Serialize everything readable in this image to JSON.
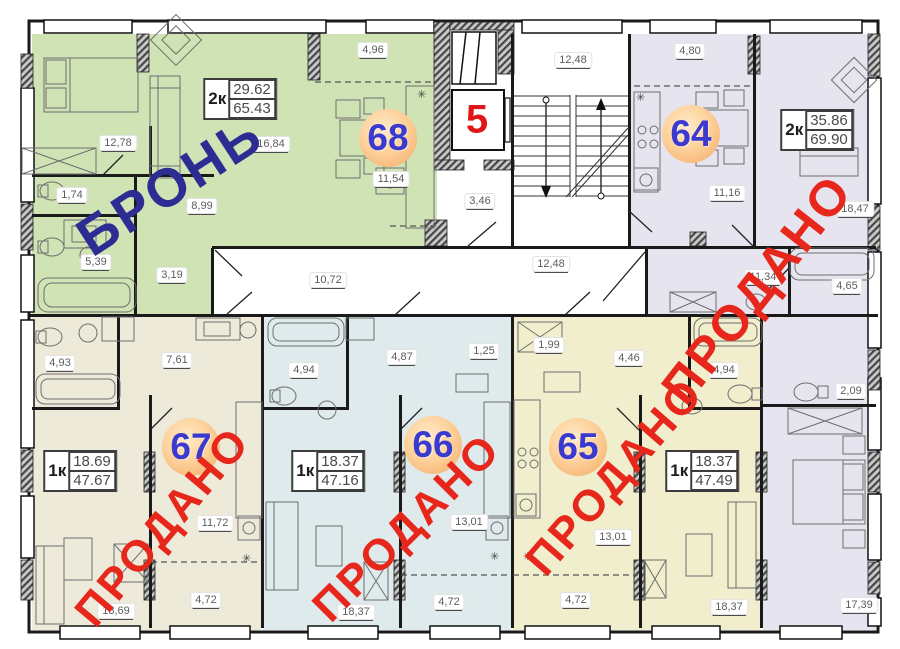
{
  "floor_plan": {
    "elevator_floor_label": "5",
    "common_areas": {
      "measurements": [
        {
          "v": "12,48",
          "x": 573,
          "y": 60
        },
        {
          "v": "3,46",
          "x": 480,
          "y": 201
        },
        {
          "v": "10,72",
          "x": 328,
          "y": 280
        },
        {
          "v": "12,48",
          "x": 551,
          "y": 264
        }
      ]
    },
    "apartments": [
      {
        "id": "68",
        "number": "68",
        "status_stamp": "БРОНЬ",
        "stamp_color": "#2c2c93",
        "type": "2к",
        "area_live": "29.62",
        "area_total": "65.43",
        "color": "#cfe3b5",
        "badge": {
          "x": 388,
          "y": 138
        },
        "spec": {
          "x": 240,
          "y": 99
        },
        "stamp": {
          "x": 170,
          "y": 186,
          "angle": -33,
          "size": 54
        },
        "measurements": [
          {
            "v": "12,78",
            "x": 118,
            "y": 143
          },
          {
            "v": "16,84",
            "x": 271,
            "y": 144
          },
          {
            "v": "4,96",
            "x": 373,
            "y": 50
          },
          {
            "v": "11,54",
            "x": 391,
            "y": 179
          },
          {
            "v": "1,74",
            "x": 72,
            "y": 195
          },
          {
            "v": "8,99",
            "x": 202,
            "y": 206
          },
          {
            "v": "5,39",
            "x": 96,
            "y": 262
          },
          {
            "v": "3,19",
            "x": 172,
            "y": 275
          }
        ]
      },
      {
        "id": "64",
        "number": "64",
        "status_stamp": "ПРОДАНО",
        "stamp_color": "#e7271b",
        "type": "2к",
        "area_live": "35.86",
        "area_total": "69.90",
        "color": "#e6e4ef",
        "badge": {
          "x": 691,
          "y": 134
        },
        "spec": {
          "x": 817,
          "y": 130
        },
        "stamp": {
          "x": 757,
          "y": 289,
          "angle": -52,
          "size": 50
        },
        "measurements": [
          {
            "v": "4,80",
            "x": 690,
            "y": 51
          },
          {
            "v": "11,16",
            "x": 727,
            "y": 193
          },
          {
            "v": "18,47",
            "x": 855,
            "y": 209
          },
          {
            "v": "11,34",
            "x": 763,
            "y": 277
          },
          {
            "v": "4,65",
            "x": 847,
            "y": 286
          },
          {
            "v": "2,09",
            "x": 851,
            "y": 391
          },
          {
            "v": "17,39",
            "x": 859,
            "y": 605
          }
        ]
      },
      {
        "id": "67",
        "number": "67",
        "status_stamp": "ПРОДАНО",
        "stamp_color": "#e7271b",
        "type": "1к",
        "area_live": "18.69",
        "area_total": "47.67",
        "color": "#edead9",
        "badge": {
          "x": 191,
          "y": 447
        },
        "spec": {
          "x": 80,
          "y": 471
        },
        "stamp": {
          "x": 163,
          "y": 527,
          "angle": -50,
          "size": 44
        },
        "measurements": [
          {
            "v": "4,93",
            "x": 60,
            "y": 363
          },
          {
            "v": "7,61",
            "x": 177,
            "y": 360
          },
          {
            "v": "11,72",
            "x": 215,
            "y": 523
          },
          {
            "v": "4,72",
            "x": 206,
            "y": 600
          },
          {
            "v": "18,69",
            "x": 116,
            "y": 611
          }
        ]
      },
      {
        "id": "66",
        "number": "66",
        "status_stamp": "ПРОДАНО",
        "stamp_color": "#e7271b",
        "type": "1к",
        "area_live": "18.37",
        "area_total": "47.16",
        "color": "#dfeaec",
        "badge": {
          "x": 433,
          "y": 445
        },
        "spec": {
          "x": 328,
          "y": 471
        },
        "stamp": {
          "x": 407,
          "y": 528,
          "angle": -45,
          "size": 44
        },
        "measurements": [
          {
            "v": "4,94",
            "x": 304,
            "y": 370
          },
          {
            "v": "4,87",
            "x": 402,
            "y": 357
          },
          {
            "v": "1,25",
            "x": 484,
            "y": 351
          },
          {
            "v": "13,01",
            "x": 469,
            "y": 522
          },
          {
            "v": "4,72",
            "x": 449,
            "y": 602
          },
          {
            "v": "18,37",
            "x": 356,
            "y": 612
          }
        ]
      },
      {
        "id": "65",
        "number": "65",
        "status_stamp": "ПРОДАНО",
        "stamp_color": "#e7271b",
        "type": "1к",
        "area_live": "18.37",
        "area_total": "47.49",
        "color": "#f0eecd",
        "badge": {
          "x": 578,
          "y": 447
        },
        "spec": {
          "x": 702,
          "y": 471
        },
        "stamp": {
          "x": 615,
          "y": 477,
          "angle": -49,
          "size": 44
        },
        "measurements": [
          {
            "v": "1,99",
            "x": 549,
            "y": 345
          },
          {
            "v": "4,46",
            "x": 629,
            "y": 358
          },
          {
            "v": "4,94",
            "x": 724,
            "y": 370
          },
          {
            "v": "13,01",
            "x": 613,
            "y": 537
          },
          {
            "v": "4,72",
            "x": 576,
            "y": 600
          },
          {
            "v": "18,37",
            "x": 729,
            "y": 607
          }
        ]
      }
    ]
  }
}
